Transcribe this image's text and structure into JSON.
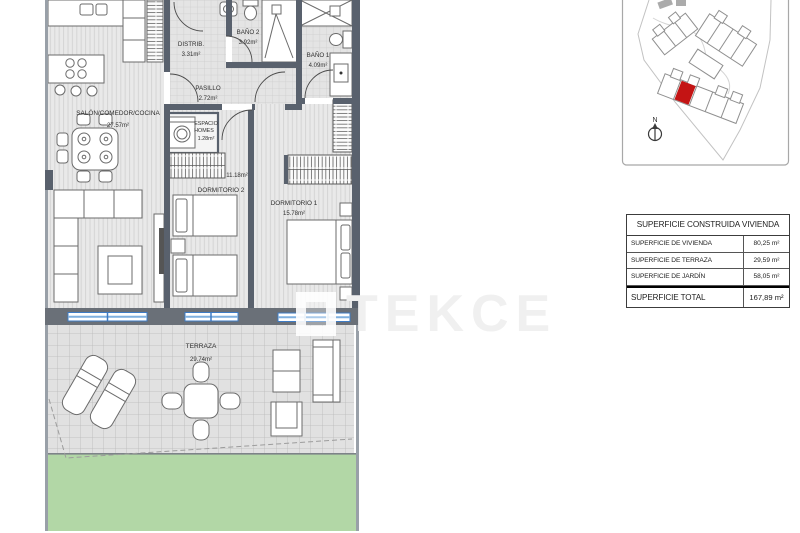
{
  "watermark": {
    "text": "TEKCE"
  },
  "floor_plan": {
    "rooms": [
      {
        "id": "salon",
        "name": "SALÓN/COMEDOR/COCINA",
        "area": "27.57m²"
      },
      {
        "id": "distribuidor",
        "name": "DISTRIB.",
        "area": "3.31m²"
      },
      {
        "id": "bano2",
        "name": "BAÑO 2",
        "area": "3.92m²"
      },
      {
        "id": "bano1",
        "name": "BAÑO 1",
        "area": "4.09m²"
      },
      {
        "id": "pasillo",
        "name": "PASILLO",
        "area": "2.72m²"
      },
      {
        "id": "espacio-homes",
        "name": "ESPACIO HOMES",
        "name_lines": [
          "ESPACIO",
          "HOMES"
        ],
        "area": "1.28m²"
      },
      {
        "id": "dormitorio2",
        "name": "DORMITORIO 2",
        "area": "11.18m²"
      },
      {
        "id": "dormitorio1",
        "name": "DORMITORIO 1",
        "area": "15.78m²"
      },
      {
        "id": "terraza",
        "name": "TERRAZA",
        "area": "29.74m²"
      }
    ]
  },
  "site_map": {
    "north_label": "N",
    "highlight_color": "#c41414"
  },
  "surface_table": {
    "header": "SUPERFICIE CONSTRUIDA VIVIENDA",
    "rows": [
      {
        "label": "SUPERFICIE DE VIVIENDA",
        "value": "80,25 m²"
      },
      {
        "label": "SUPERFICIE DE TERRAZA",
        "value": "29,59 m²"
      },
      {
        "label": "SUPERFICIE DE JARDÍN",
        "value": "58,05 m²"
      }
    ],
    "total": {
      "label": "SUPERFICIE TOTAL",
      "value": "167,89 m²"
    }
  },
  "colors": {
    "wall": "#59616d",
    "window_blue": "#3e7bc4",
    "garden_green": "#b2d7a6",
    "highlight_red": "#c41414"
  }
}
